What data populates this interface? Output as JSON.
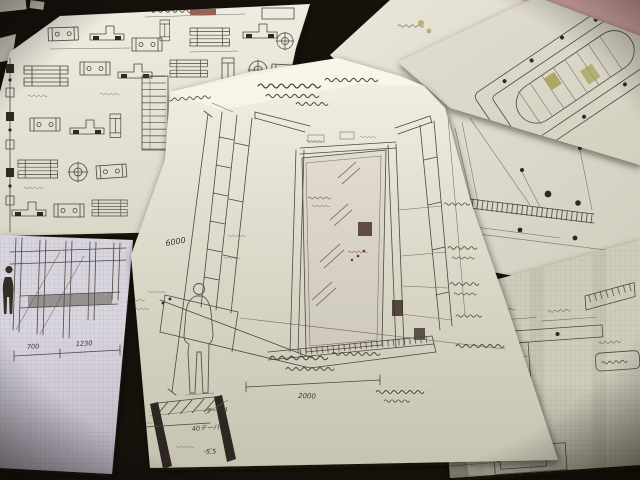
{
  "colors": {
    "background": "#17110c",
    "paper_main": "#e6e2d3",
    "paper_grid_left": "#d8d4de",
    "paper_grid_right": "#d0ccbc",
    "ink": "#4b463e",
    "pink_sheet": "#d9aba6",
    "highlight_olive": "#a3a050",
    "annotation_red": "#8a4a5a"
  },
  "sheets": {
    "main": {
      "height_dimension": "6000",
      "width_dimension": "2000",
      "base_detail": {
        "label_top": "テーパ4",
        "label_mid": "40テーパ",
        "label_bottom": "5.5"
      }
    },
    "grid_left": {
      "dimension_left": "700",
      "dimension_right": "1230"
    }
  }
}
